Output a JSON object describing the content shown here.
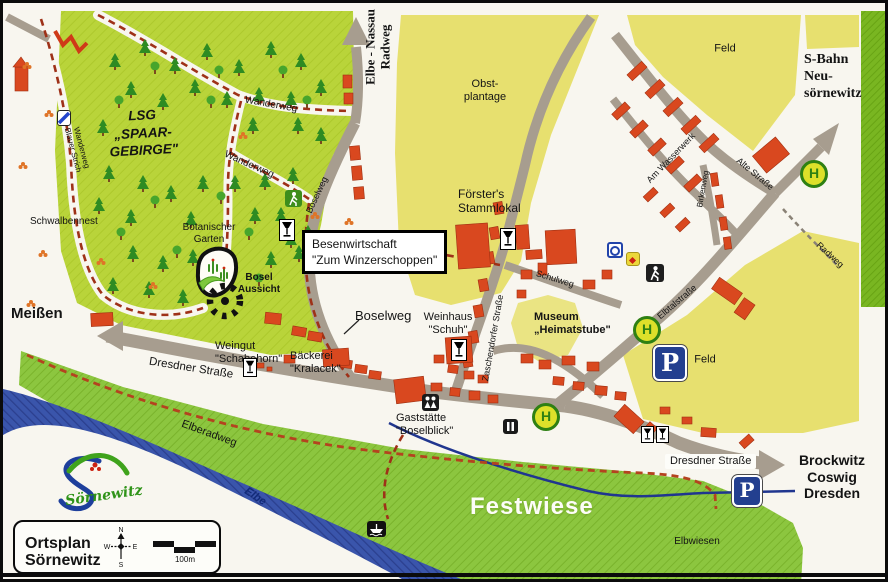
{
  "map_title": "Ortsplan Sörnewitz",
  "colors": {
    "forest_green": "#b9d43a",
    "meadow_green": "#8cc63f",
    "field_yellow": "#e7e06f",
    "road_grey": "#a79d8f",
    "river_blue": "#3a55ab",
    "building_red": "#d9481f",
    "trail_red": "#9e3118",
    "parking_blue": "#233f8f",
    "bus_stop_green": "#2e8013"
  },
  "areas": {
    "lsg": "LSG\n„SPAAR-\nGEBIRGE\"",
    "obstplantage": "Obst-\nplantage",
    "feld_north": "Feld",
    "feld_east": "Feld",
    "schwalbennest": "Schwalbennest",
    "botanischer_garten": "Botanischer\nGarten",
    "bosel_aussicht": "Bosel\nAussicht",
    "festwiese": "Festwiese",
    "elbwiesen": "Elbwiesen"
  },
  "pois": {
    "besenwirtschaft": "Besenwirtschaft\n\"Zum Winzerschoppen\"",
    "foersters_stammlokal": "Förster's\nStammlokal",
    "weinhaus_schuh": "Weinhaus\n\"Schuh\"",
    "museum_heimatstube": "Museum\n„Heimatstube\"",
    "weingut_schabehorn": "Weingut\n\"Schabehorn\"",
    "baeckerei_kralacek": "Bäckerei\n\"Kralacek\"",
    "gaststaette_boselblick": "Gaststätte\n\"Boselblick\""
  },
  "streets": {
    "dresdner_west": "Dresdner Straße",
    "dresdner_east": "Dresdner Straße",
    "boselweg_sign": "Boselweg",
    "boselweg_street": "Boselweg",
    "schulweg": "Schulweg",
    "zaschendorfer": "Zaschendorfer Straße",
    "am_wasserwerk": "Am Wasserwerk",
    "birkenweg": "Birkenweg",
    "alte_strasse": "Alte Straße",
    "elbtalstrasse": "Elbtalstraße",
    "radweg_ne": "Radweg",
    "elberadweg": "Elberadweg",
    "elbe_nassau_radweg": "Elbe - Nassau\nRadweg",
    "wanderweg_1": "Wanderweg",
    "wanderweg_2": "Wanderweg",
    "wanderweg_blauer_strich": "Wanderweg\nBlauer Strich"
  },
  "waters": {
    "elbe": "Elbe"
  },
  "destinations": {
    "meissen": "Meißen",
    "brockwitz_group": "Brockwitz\nCoswig\nDresden",
    "sbahn": "S-Bahn\nNeu-\nsörnewitz"
  },
  "legend": {
    "title": "Ortsplan\nSörnewitz",
    "scale_label": "100m",
    "compass_n": "N",
    "compass_e": "E",
    "compass_s": "S",
    "compass_w": "W"
  },
  "logo": {
    "text": "Sörnewitz"
  },
  "markers": {
    "bus_stop_letter": "H",
    "parking_letter": "P"
  },
  "icons": {
    "wine_glass": "wine-glass",
    "hiker": "hiker",
    "viewpoint": "viewpoint-rays",
    "bus_stop": "H-circle",
    "parking": "P-square",
    "people": "two-people",
    "info": "info-board",
    "ferry": "ferry",
    "trail_marker": "blue-stripe",
    "poi_blue": "blue-ring",
    "poi_yellow": "red-diamond"
  }
}
